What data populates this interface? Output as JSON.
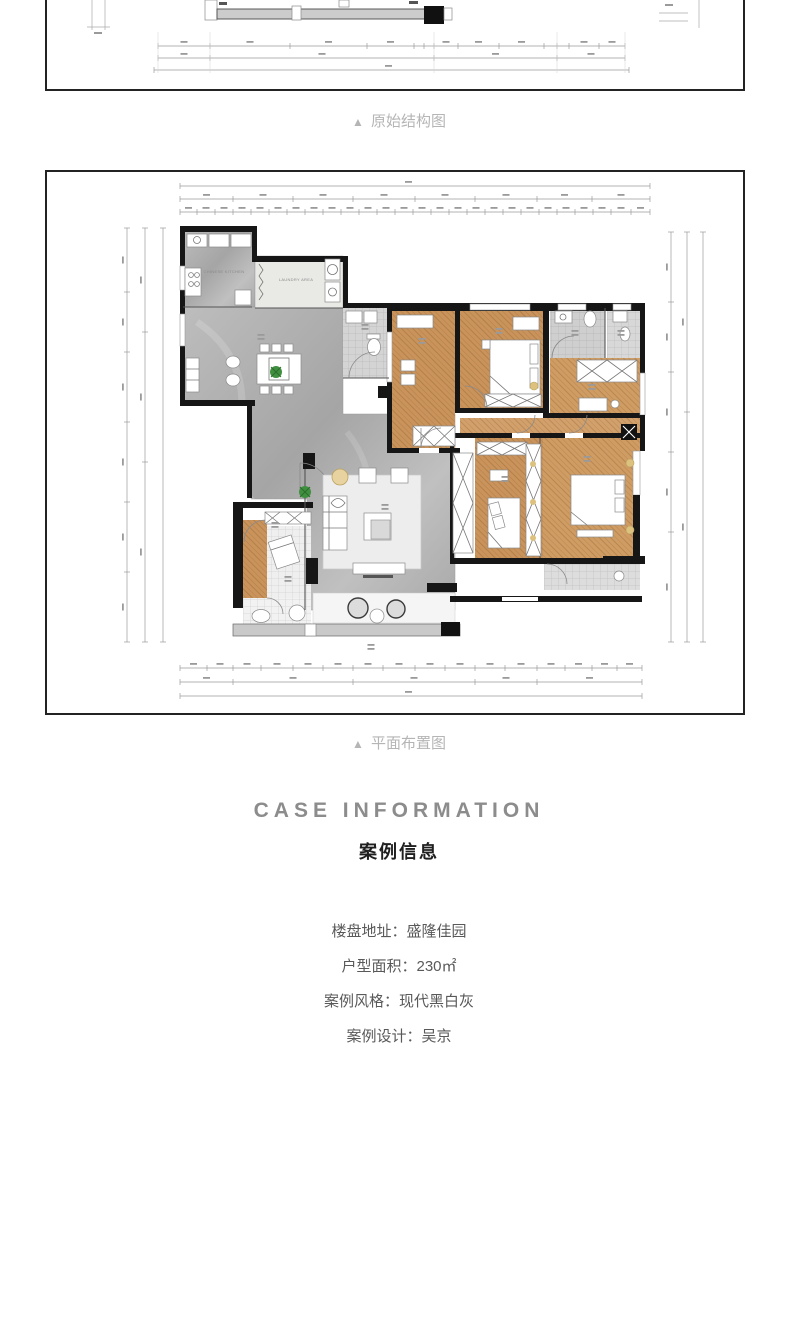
{
  "panels": {
    "structure": {
      "caption_marker": "▲",
      "caption": "原始结构图"
    },
    "plan": {
      "caption_marker": "▲",
      "caption": "平面布置图",
      "room_labels": [
        "CHINESE KITCHEN",
        "LAUNDRY AREA"
      ]
    }
  },
  "case_info": {
    "heading_en": "CASE INFORMATION",
    "heading_zh": "案例信息",
    "fields": [
      {
        "label": "楼盘地址：",
        "value": "盛隆佳园"
      },
      {
        "label": "户型面积：",
        "value": "230㎡"
      },
      {
        "label": "案例风格：",
        "value": "现代黑白灰"
      },
      {
        "label": "案例设计：",
        "value": "吴京"
      }
    ]
  },
  "colors": {
    "wall": "#161616",
    "wood_floor": "#c9935b",
    "marble_floor": "#adadad",
    "tile_floor": "#d4d4d4",
    "caption_gray": "#b5b5b5",
    "heading_gray": "#8c8c8c",
    "text_gray": "#595959",
    "plant_green": "#3f8f3f",
    "lamp_tan": "#e8d3a0"
  }
}
